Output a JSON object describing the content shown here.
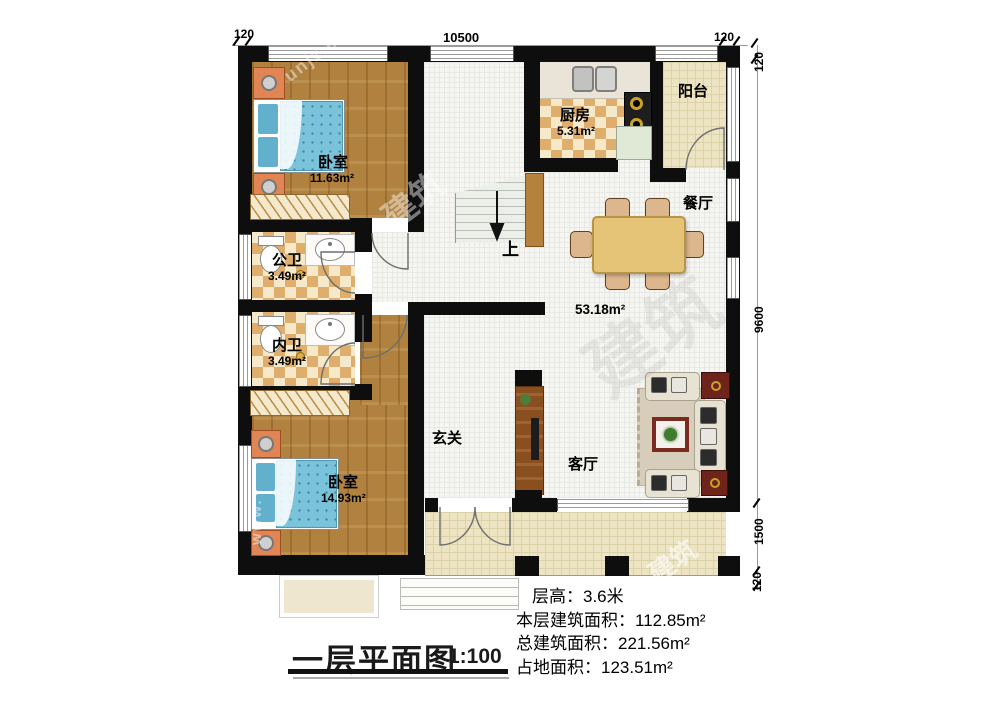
{
  "dimensions": {
    "top": {
      "left": "120",
      "span": "10500",
      "right": "120",
      "corner": "120"
    },
    "right": {
      "main": "9600",
      "porch": "1500",
      "bottom": "120"
    }
  },
  "rooms": {
    "bedroom1": {
      "name": "卧室",
      "area": "11.63m²"
    },
    "kitchen": {
      "name": "厨房",
      "area": "5.31m²"
    },
    "balcony": {
      "name": "阳台"
    },
    "dining": {
      "name": "餐厅"
    },
    "bath_public": {
      "name": "公卫",
      "area": "3.49m²"
    },
    "bath_private": {
      "name": "内卫",
      "area": "3.49m²"
    },
    "bedroom2": {
      "name": "卧室",
      "area": "14.93m²"
    },
    "foyer": {
      "name": "玄关"
    },
    "living": {
      "name": "客厅"
    },
    "open_area": {
      "area": "53.18m²"
    },
    "stairs": {
      "label": "上"
    }
  },
  "footer": {
    "title": "一层平面图",
    "scale": "1:100",
    "stats": [
      "层高：3.6米",
      "本层建筑面积：112.85m²",
      "总建筑面积：221.56m²",
      "占地面积：123.51m²"
    ]
  },
  "watermark": {
    "site": "unjz.com",
    "text": "建筑",
    "www": "www."
  },
  "colors": {
    "wall": "#0e0e0e",
    "wood": "#b0813f",
    "checker": "#dfae6d",
    "mattress": "#7ac3da",
    "table": "#e5c478"
  }
}
